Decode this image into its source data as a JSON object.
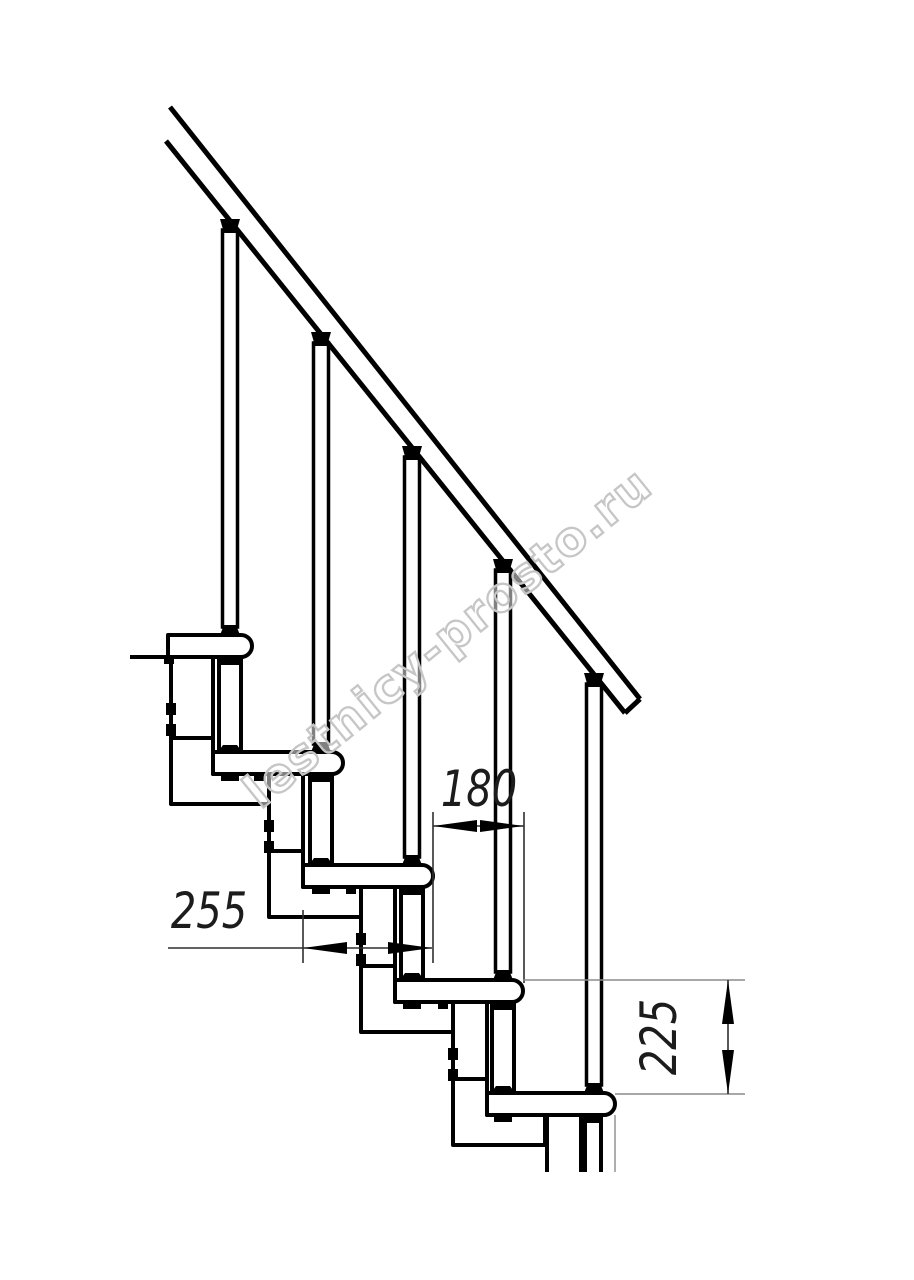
{
  "page": {
    "background": "#ffffff"
  },
  "drawing": {
    "type": "modular-staircase-side-view",
    "steps_visible": 5,
    "watermark": {
      "text": "lestnicy-prosto.ru",
      "color": "#c6c6c6"
    },
    "dimensions": {
      "run": {
        "value": "180"
      },
      "depth": {
        "value": "255"
      },
      "rise": {
        "value": "225"
      }
    },
    "colors": {
      "line": "#000000",
      "dimension_line": "#2f2f2f",
      "extension_line_light": "#8c8c8c",
      "background": "#ffffff"
    }
  }
}
